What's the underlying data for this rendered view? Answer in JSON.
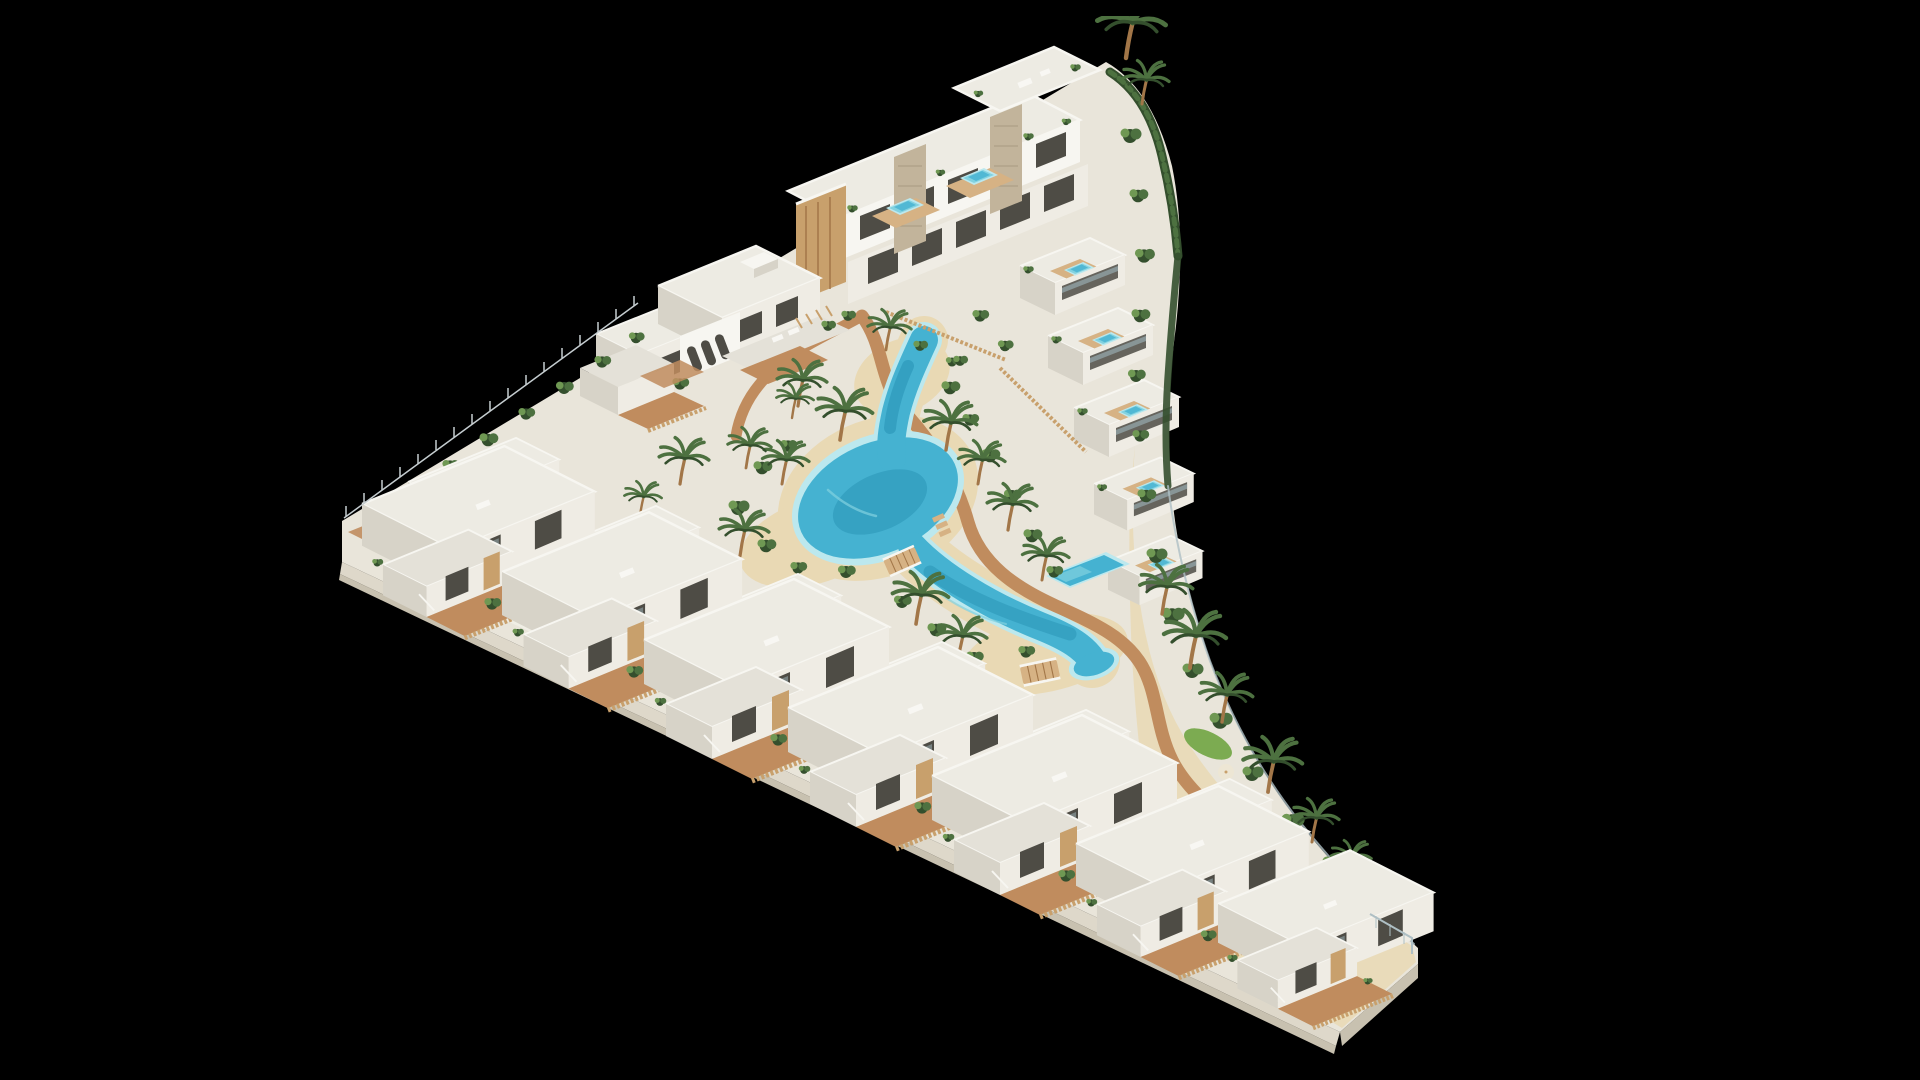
{
  "caption": "Aerial 3D architectural rendering on a black background: a triangular coastal residential development of white Mediterranean villas and apartment blocks arranged around a winding turquoise lagoon pool with sandy beaches, wooden boardwalks, two timber bridges, rooftop spa pools, green hedges and palm trees.",
  "development": {
    "front_row_villas": 7,
    "back_row_villas": 6,
    "apartment_blocks": 2,
    "terraced_units": 5,
    "bridges": 2,
    "rooftop_spa_pools": 7,
    "lagoon_pools": 1,
    "private_pools": 1
  },
  "palette": {
    "bg": "#000000",
    "groundLight": "#e9e5da",
    "groundWhite": "#f1efe7",
    "plinth": "#ded8ca",
    "plinthShade": "#c8c1b0",
    "sand": "#e9d9b4",
    "pathTerra": "#c08c5e",
    "wood": "#c8a06c",
    "woodDark": "#a27648",
    "deck": "#d6b284",
    "stone": "#c2b49b",
    "stoneDark": "#a89a82",
    "wallBright": "#f7f6f1",
    "wallLit": "#efece4",
    "wallShade": "#d7d3c8",
    "wallDark": "#bdb8ab",
    "roofTop": "#edebe3",
    "roofLow": "#e4e1d8",
    "voidDark": "#4e4c45",
    "glass": "#9fb6bc",
    "waterRim": "#bce8ee",
    "waterLight": "#82d2e0",
    "water": "#45b2d1",
    "waterDeep": "#2089ad",
    "greenDark": "#344f2d",
    "green": "#4d7140",
    "greenLight": "#6f9853",
    "lawn": "#7cab51",
    "fenceLine": "#c5cdd0",
    "glassFence": "#aebfc4"
  }
}
